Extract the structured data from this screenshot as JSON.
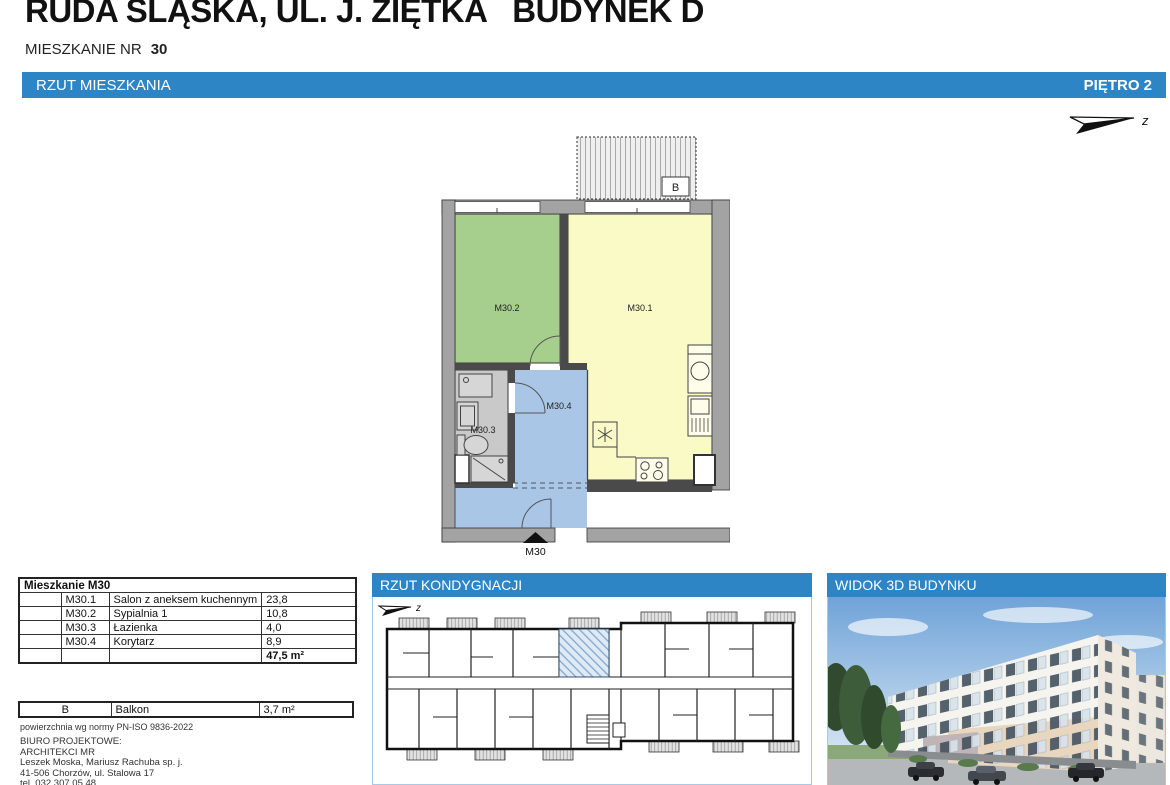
{
  "header": {
    "title": "RUDA ŚLĄSKA, UL. J. ZIĘTKA   BUDYNEK D",
    "apartment_label": "MIESZKANIE NR",
    "apartment_number": "30"
  },
  "main_bar": {
    "left": "RZUT MIESZKANIA",
    "right": "PIĘTRO 2"
  },
  "north_label": "z",
  "floorplan": {
    "balcony_label": "B",
    "entrance_label": "M30",
    "room_labels": {
      "living": "M30.1",
      "bedroom": "M30.2",
      "bath": "M30.3",
      "corridor": "M30.4"
    }
  },
  "area_table": {
    "title": "Mieszkanie M30",
    "rows": [
      {
        "code": "M30.1",
        "name": "Salon z aneksem kuchennym",
        "area": "23,8"
      },
      {
        "code": "M30.2",
        "name": "Sypialnia 1",
        "area": "10,8"
      },
      {
        "code": "M30.3",
        "name": "Łazienka",
        "area": "4,0"
      },
      {
        "code": "M30.4",
        "name": "Korytarz",
        "area": "8,9"
      }
    ],
    "total": "47,5 m²"
  },
  "balcony_table": {
    "rows": [
      {
        "code": "B",
        "name": "Balkon",
        "area": "3,7 m²"
      }
    ]
  },
  "norm_note": "powierzchnia wg normy PN-ISO 9836-2022",
  "office": {
    "label": "BIURO PROJEKTOWE:",
    "name": "ARCHITEKCI MR",
    "partners": "Leszek Moska, Mariusz Rachuba sp. j.",
    "address": "41-506 Chorzów, ul. Stalowa 17",
    "phone": "tel. 032 307 05 48."
  },
  "panels": {
    "kondygnacja_title": "RZUT KONDYGNACJI",
    "widok3d_title": "WIDOK 3D BUDYNKU"
  },
  "colors": {
    "accent": "#2d85c5",
    "living": "#fafac6",
    "bedroom": "#a6cf8d",
    "bath": "#c9c9c9",
    "corridor": "#a9c6e6"
  }
}
